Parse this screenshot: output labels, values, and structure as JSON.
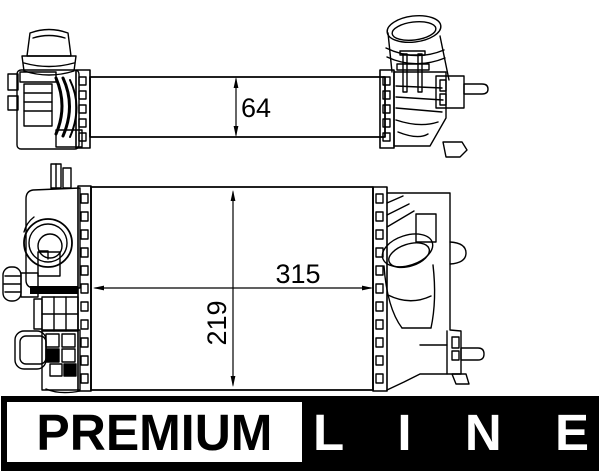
{
  "drawing": {
    "title": "intercooler-technical-drawing",
    "dimensions": {
      "core_depth_top_view": "64",
      "core_width_front_view": "315",
      "core_height_front_view": "219"
    },
    "line_color": "#000000",
    "background_color": "#ffffff"
  },
  "logo": {
    "premium_label": "PREMIUM",
    "line_letters": [
      "L",
      "I",
      "N",
      "E"
    ],
    "bar_color": "#000000",
    "box_color": "#ffffff"
  }
}
